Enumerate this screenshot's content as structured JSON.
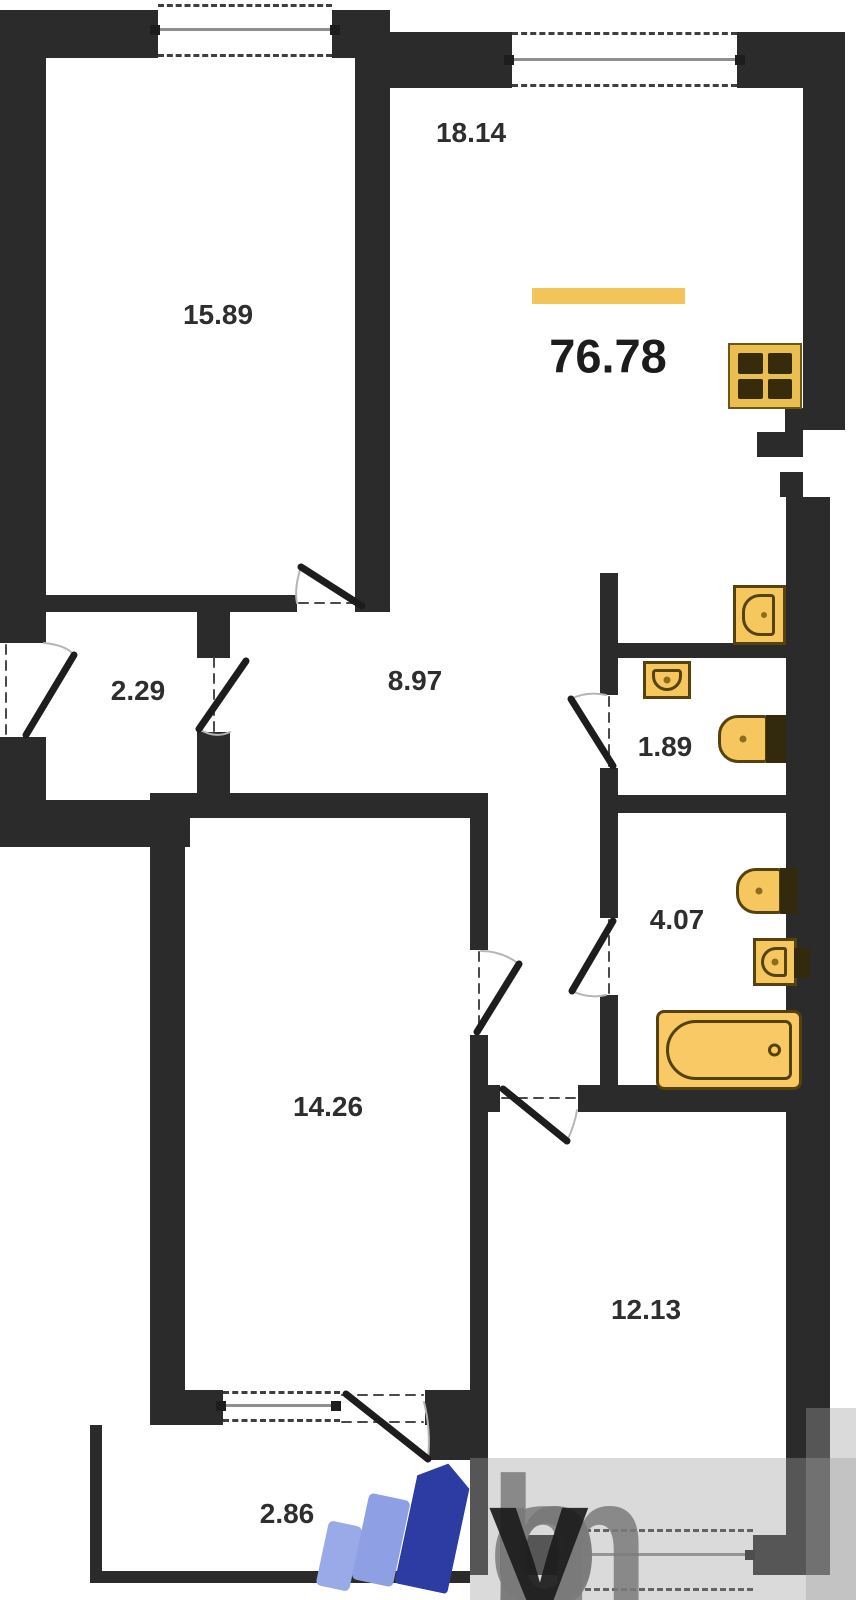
{
  "floor_plan": {
    "total_area": "76.78",
    "rooms": [
      {
        "name": "room-top-left",
        "area": "15.89"
      },
      {
        "name": "kitchen-living",
        "area": "18.14"
      },
      {
        "name": "entry-closet",
        "area": "2.29"
      },
      {
        "name": "hallway",
        "area": "8.97"
      },
      {
        "name": "wc",
        "area": "1.89"
      },
      {
        "name": "bathroom",
        "area": "4.07"
      },
      {
        "name": "room-bottom-left",
        "area": "14.26"
      },
      {
        "name": "room-bottom-right",
        "area": "12.13"
      },
      {
        "name": "balcony",
        "area": "2.86"
      }
    ],
    "fixtures": [
      "stove",
      "kitchen-sink",
      "wc-sink",
      "wc-toilet",
      "bathroom-toilet",
      "bathroom-sink",
      "bathtub"
    ],
    "colors": {
      "wall": "#2b2b2b",
      "fixture_fill": "#f6c75f",
      "fixture_outline": "#54430f",
      "total_area_bar": "#f2c459",
      "label_text": "#2e2e2e"
    }
  },
  "watermark": {
    "brand": "moby",
    "letters": [
      "m",
      "o",
      "b",
      "y"
    ],
    "logo_colors": {
      "light_blue": "#8f9fe4",
      "dark_blue": "#2d3ca3",
      "text_gray": "#7a7a7a",
      "text_dark": "#1c1c1c"
    }
  }
}
